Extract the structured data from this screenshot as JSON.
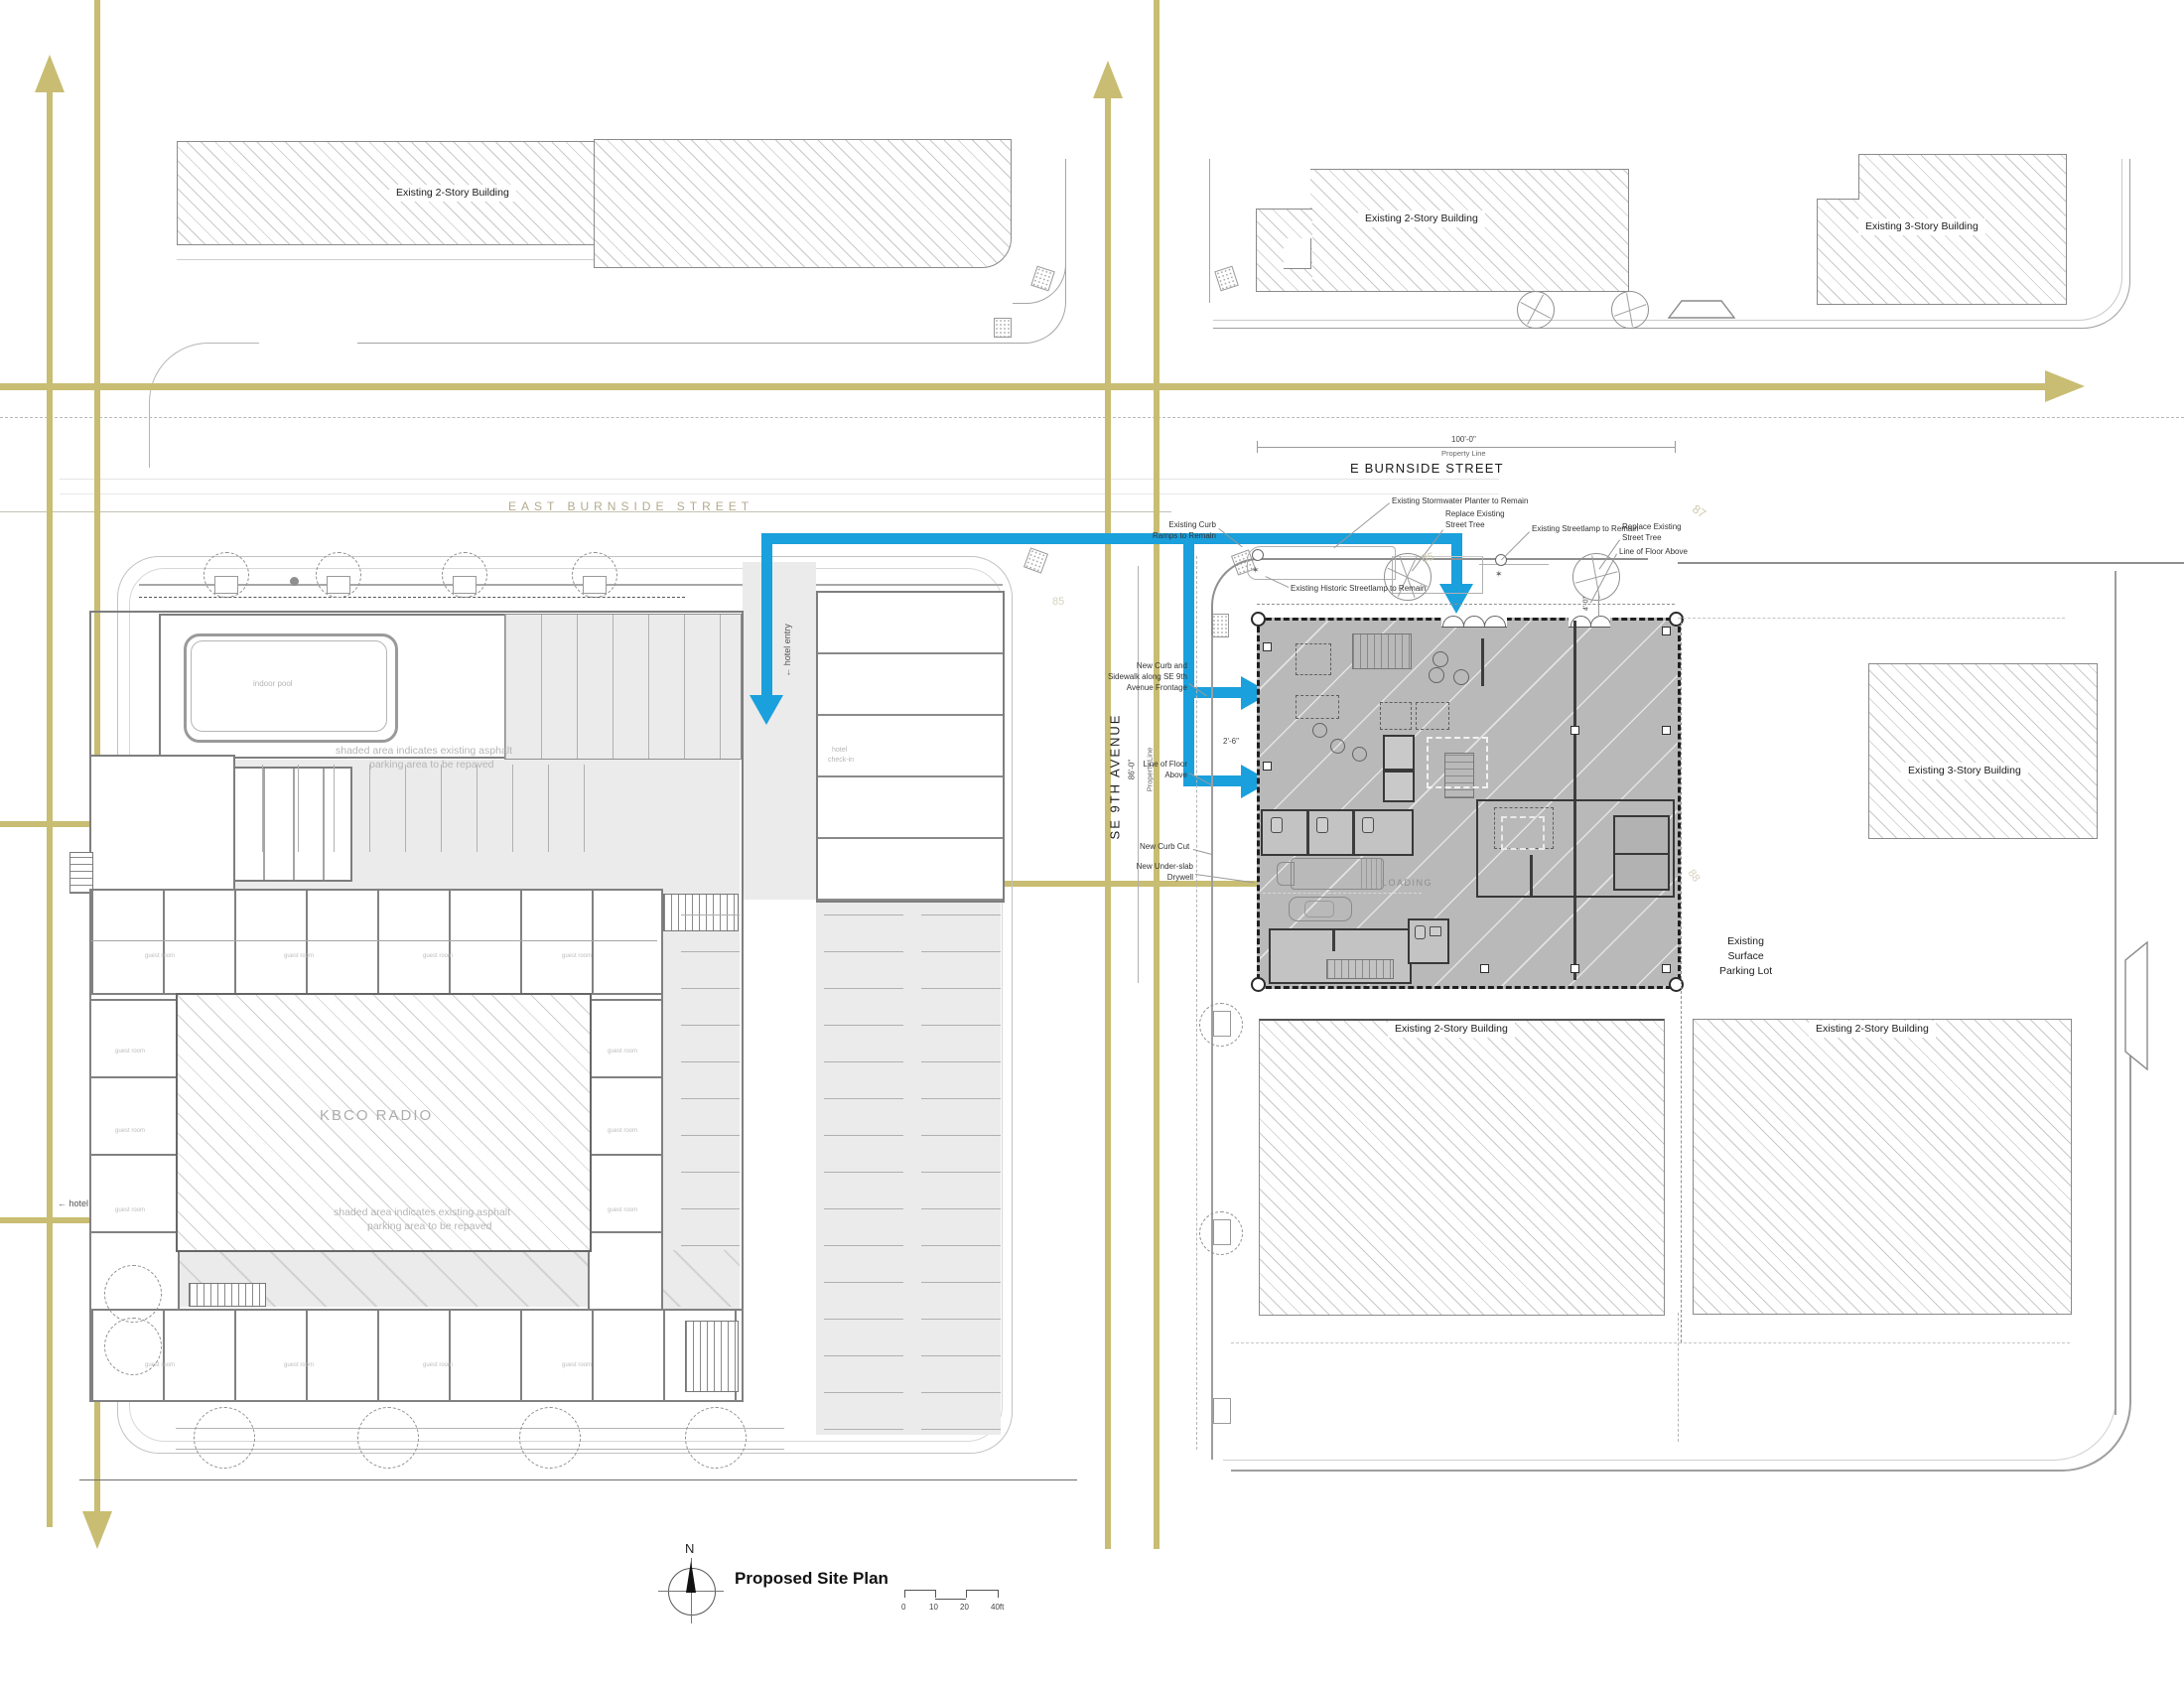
{
  "title_block": {
    "north": "N",
    "title": "Proposed Site Plan",
    "scale": [
      "0",
      "10",
      "20",
      "40ft"
    ]
  },
  "streets": {
    "e_burnside": "E BURNSIDE STREET",
    "east_burnside_ghost": "EAST BURNSIDE STREET",
    "se_9th": "SE 9TH AVENUE"
  },
  "context_buildings": {
    "nw_2story": "Existing 2-Story Building",
    "n_mid_2story": "Existing 2-Story Building",
    "ne_3story": "Existing 3-Story Building",
    "e_3story": "Existing 3-Story Building",
    "s_2story": "Existing 2-Story Building",
    "se_2story": "Existing 2-Story Building",
    "surface_parking": [
      "Existing",
      "Surface",
      "Parking  Lot"
    ]
  },
  "hotel": {
    "kbco": "KBCO RADIO",
    "indoor_pool": "indoor pool",
    "check_in_1": "hotel",
    "check_in_2": "check-in",
    "guest_room": "guest room",
    "repave_1": "shaded area indicates existing asphalt",
    "repave_2": "parking area to be repaved",
    "entry": "hotel entry",
    "exit": "hotel exit",
    "arrow_glyph": "←"
  },
  "proposed": {
    "loading": "LOADING"
  },
  "callouts": {
    "curb_ramps_1": "Existing Curb",
    "curb_ramps_2": "Ramps to Remain",
    "stormwater": "Existing Stormwater Planter to Remain",
    "replace_tree_1": "Replace Existing",
    "replace_tree_2": "Street Tree",
    "streetlamp": "Existing Streetlamp to Remain",
    "replace_tree2_1": "Replace Existing",
    "replace_tree2_2": "Street Tree",
    "floor_above": "Line of Floor Above",
    "historic_lamp": "Existing Historic Streetlamp to Remain",
    "new_curb_1": "New Curb and",
    "new_curb_2": "Sidewalk along SE 9th",
    "new_curb_3": "Avenue Frontage",
    "floor_above2_1": "Line of Floor",
    "floor_above2_2": "Above",
    "curb_cut": "New Curb Cut",
    "drywell_1": "New Under-slab",
    "drywell_2": "Drywell"
  },
  "dimensions": {
    "prop_w": "100'-0\"",
    "prop_label": "Property Line",
    "prop_h": "86'-0\"",
    "floor_offset": "4'-0\"",
    "setback": "2'-6\"",
    "c85": "85",
    "c87": "87",
    "c88": "88"
  }
}
